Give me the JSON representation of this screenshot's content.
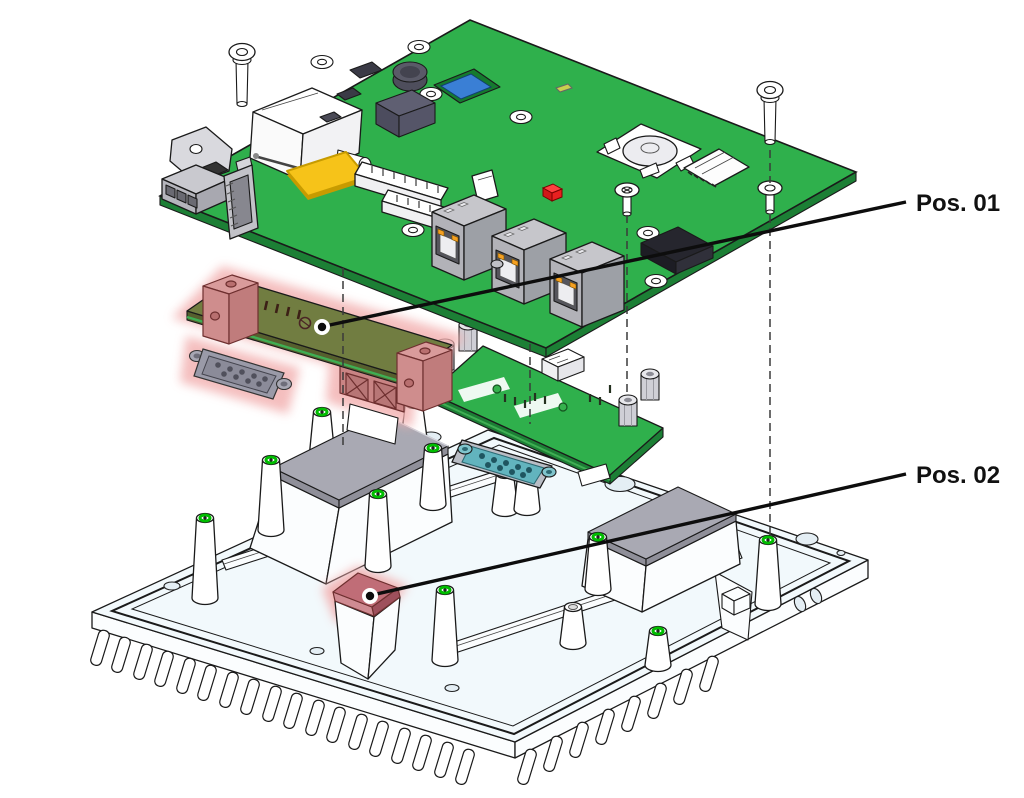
{
  "window": {
    "width": 1024,
    "height": 798,
    "background": "#ffffff"
  },
  "callouts": [
    {
      "label": "Pos. 01"
    },
    {
      "label": "Pos. 02"
    }
  ],
  "parts": [
    "mainboard-pcb",
    "plugin-module-highlighted",
    "interface-board",
    "heatsink-chassis",
    "thermal-pad-left",
    "thermal-pad-right",
    "thermal-pad-highlighted",
    "mounting-screws"
  ],
  "colors": {
    "pcb_green": "#2fb04c",
    "pcb_edge": "#1c7f35",
    "module_olive": "#717d41",
    "module_olive_dark": "#565f2e",
    "module_edge_green": "#3fae53",
    "highlight_pink": "#f2aeae",
    "bracket_rose": "#cf8d8d",
    "bracket_rose_dark": "#6e2f2f",
    "terminal_rose": "#c98484",
    "connector_gray": "#9a9aa8",
    "db9_teal": "#62b4be",
    "db9_teal_dark": "#1f5560",
    "chassis_fill": "#f2f9fc",
    "chassis_wall": "#fbfdfe",
    "pad_gray": "#a9a9b3",
    "pad_gray_side": "#8f8f99",
    "pad_red": "#c06d77",
    "pad_red_light": "#cf8b92",
    "pad_red_dark": "#9e505c",
    "green_ring": "#00bd00",
    "led_orange": "#f5a021",
    "comp_dark": "#3a3a46",
    "comp_red": "#e82020",
    "comp_yellow": "#f6c319",
    "comp_yellow_dark": "#c79b00",
    "comp_blue": "#3a7fd5",
    "label_color": "#111111"
  }
}
